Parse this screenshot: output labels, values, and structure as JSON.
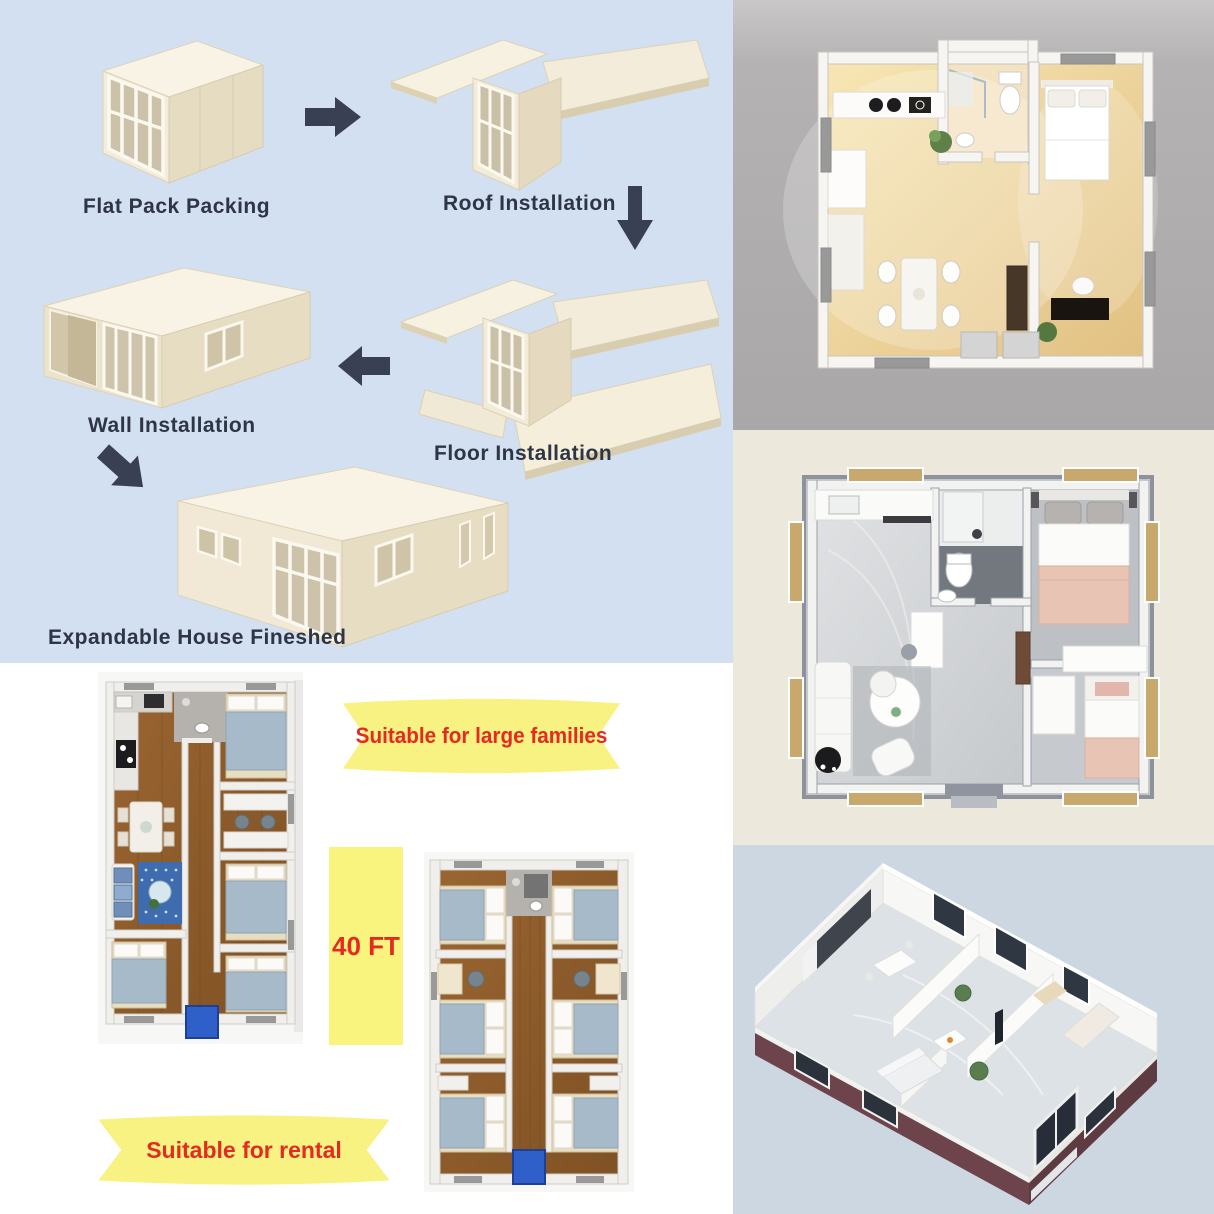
{
  "steps_panel": {
    "background_color": "#d3e0f2",
    "label_color": "#2e3545",
    "arrow_color": "#3a4054",
    "steps": [
      {
        "label": "Flat Pack Packing"
      },
      {
        "label": "Roof Installation"
      },
      {
        "label": "Floor Installation"
      },
      {
        "label": "Wall Installation"
      },
      {
        "label": "Expandable House Fineshed"
      }
    ]
  },
  "plans_panel": {
    "background_color": "#ffffff",
    "size_label": {
      "text": "40 FT",
      "background_color": "#f9f47d",
      "text_color": "#e42a21"
    },
    "banners": [
      {
        "text": "Suitable for large families",
        "background_color": "#f7f282",
        "text_color": "#e42a21"
      },
      {
        "text": "Suitable for rental",
        "background_color": "#f7f282",
        "text_color": "#e42a21"
      }
    ]
  },
  "right_column": {
    "top_image": {
      "name": "top-view-floor-plan-warm-wood",
      "background_color": "#b2b0b1"
    },
    "middle_image": {
      "name": "top-view-floor-plan-two-bedroom",
      "background_color": "#ece8dc"
    },
    "bottom_image": {
      "name": "isometric-cutaway-container-house",
      "background_color": "#ccd7e2"
    }
  }
}
